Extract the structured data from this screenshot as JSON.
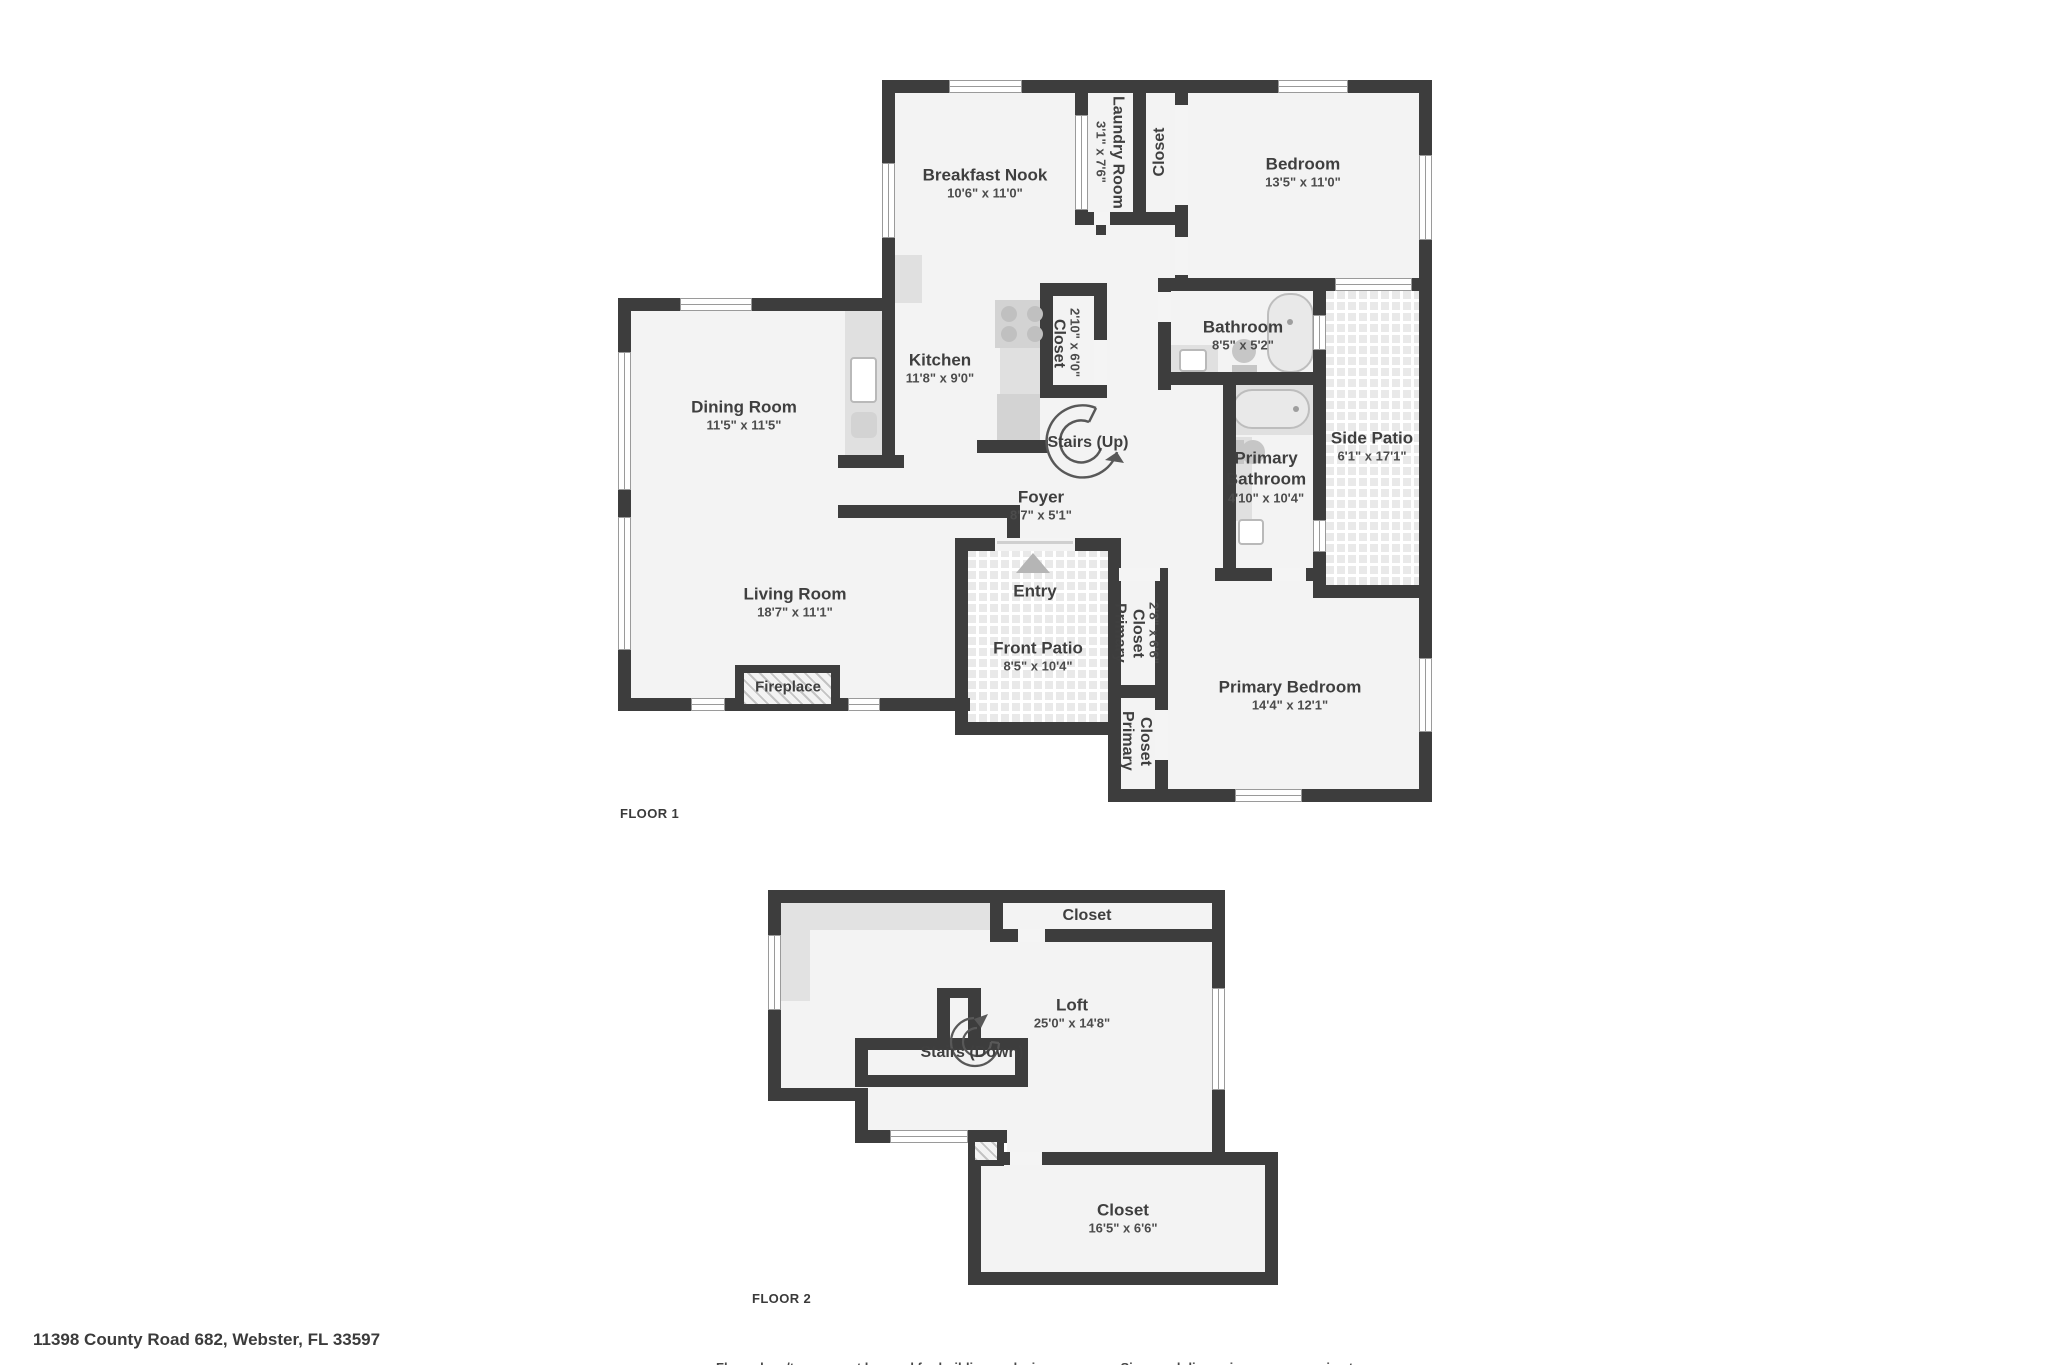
{
  "palette": {
    "wall": "#3d3d3d",
    "floor": "#f3f3f3",
    "patio_tile": "#e9e9e9",
    "fixture": "#d3d3d3",
    "text": "#3f3f3f"
  },
  "floor1": {
    "label": "FLOOR 1",
    "rooms": [
      {
        "name": "Breakfast Nook",
        "dims": "10'6\" x 11'0\""
      },
      {
        "name": "Laundry Room",
        "dims": "3'1\" x 7'6\""
      },
      {
        "name": "Closet",
        "dims": ""
      },
      {
        "name": "Bedroom",
        "dims": "13'5\" x 11'0\""
      },
      {
        "name": "Dining Room",
        "dims": "11'5\" x 11'5\""
      },
      {
        "name": "Kitchen",
        "dims": "11'8\" x 9'0\""
      },
      {
        "name": "Closet",
        "dims": "2'10\" x 6'0\""
      },
      {
        "name": "Bathroom",
        "dims": "8'5\" x 5'2\""
      },
      {
        "name": "Stairs (Up)",
        "dims": ""
      },
      {
        "name": "Primary Bathroom",
        "dims": "4'10\" x 10'4\""
      },
      {
        "name": "Side Patio",
        "dims": "6'1\" x 17'1\""
      },
      {
        "name": "Foyer",
        "dims": "8'7\" x 5'1\""
      },
      {
        "name": "Living Room",
        "dims": "18'7\" x 11'1\""
      },
      {
        "name": "Entry",
        "dims": ""
      },
      {
        "name": "Front Patio",
        "dims": "8'5\" x 10'4\""
      },
      {
        "name": "Fireplace",
        "dims": ""
      },
      {
        "name": "Primary Closet",
        "dims": "2'8\" x 6'6\""
      },
      {
        "name": "Primary Closet",
        "dims": ""
      },
      {
        "name": "Primary Bedroom",
        "dims": "14'4\" x 12'1\""
      }
    ]
  },
  "floor2": {
    "label": "FLOOR 2",
    "rooms": [
      {
        "name": "Closet",
        "dims": ""
      },
      {
        "name": "Loft",
        "dims": "25'0\" x 14'8\""
      },
      {
        "name": "Stairs (Down)",
        "dims": ""
      },
      {
        "name": "Closet",
        "dims": "16'5\" x 6'6\""
      }
    ]
  },
  "footer": {
    "address": "11398 County Road 682, Webster, FL 33597",
    "disclaimer": "Floor plans/tour cannot be used for building or design purposes. Sizes and dimensions are approximate."
  }
}
